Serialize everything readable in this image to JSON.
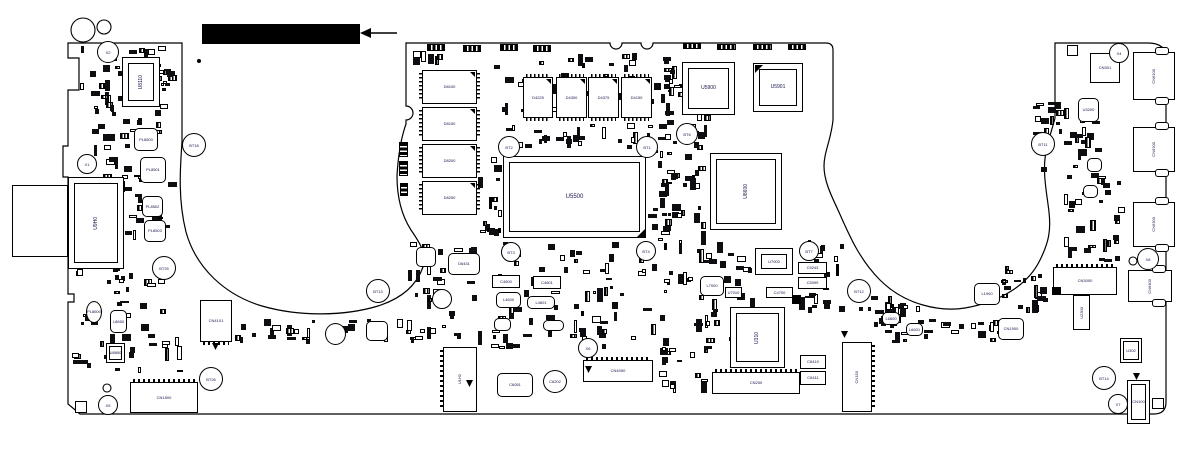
{
  "annotation": {
    "redacted_label": {
      "x": 202,
      "y": 24,
      "w": 158,
      "h": 20,
      "color": "#000000"
    },
    "arrow": {
      "x1": 397,
      "y1": 33,
      "x2": 368,
      "y2": 33,
      "head": [
        [
          360,
          33
        ],
        [
          371,
          28
        ],
        [
          371,
          38
        ]
      ]
    }
  },
  "board": {
    "colors": {
      "outline": "#000000",
      "fill": "#ffffff",
      "label": "#14144a",
      "part_dark": "#0d0d12"
    },
    "outline_paths": [
      "M68 43 L182 43 L182 142 C180 170 178 200 186 232 C196 268 225 295 262 306 C300 317 345 316 378 306 C400 299 416 287 423 267 C427 254 420 243 411 230 C402 216 397 198 397 176 C398 158 401 138 406 124 L406 120 A7 7 0 0 0 406 106 L406 43 L610 43 A6 6 0 0 0 622 43 L641 43 A6 6 0 0 0 653 43 L826 43 Q833 43 833 50 L833 120 C831 140 824 152 824 166 C824 180 830 193 838 210 C848 232 858 258 880 280 C905 305 940 312 965 308 C1000 302 1028 285 1040 260 C1049 242 1051 230 1049 212 C1047 194 1042 172 1046 152 C1048 140 1052 130 1055 118 L1055 43 L1148 43 Q1166 43 1166 58 L1166 402 Q1166 414 1154 414 L80 414 L68 404 L68 302 L74 302 L74 294 L68 294 L68 177 L63 177 L63 146 L68 146 L68 90 L79 90 L79 58 L68 58 Z"
    ],
    "holes": [
      {
        "x": 83,
        "y": 30,
        "r": 12
      },
      {
        "x": 104,
        "y": 27,
        "r": 7
      },
      {
        "x": 107,
        "y": 388,
        "r": 4
      },
      {
        "x": 1133,
        "y": 261,
        "r": 4
      }
    ],
    "dots": [
      {
        "x": 199,
        "y": 61,
        "r": 2
      }
    ],
    "ref_circles": [
      {
        "label": "X2",
        "x": 107,
        "y": 51,
        "r": 10
      },
      {
        "label": "X1",
        "x": 86,
        "y": 163,
        "r": 9
      },
      {
        "label": "BT18",
        "x": 193,
        "y": 144,
        "r": 11
      },
      {
        "label": "BT25",
        "x": 163,
        "y": 267,
        "r": 11
      },
      {
        "label": "BT26",
        "x": 210,
        "y": 378,
        "r": 11
      },
      {
        "label": "X5",
        "x": 107,
        "y": 404,
        "r": 9
      },
      {
        "label": "BT13",
        "x": 377,
        "y": 290,
        "r": 11
      },
      {
        "label": "BT2",
        "x": 508,
        "y": 146,
        "r": 10
      },
      {
        "label": "BT1",
        "x": 646,
        "y": 146,
        "r": 10
      },
      {
        "label": "BT6",
        "x": 686,
        "y": 133,
        "r": 10
      },
      {
        "label": "BT3",
        "x": 510,
        "y": 251,
        "r": 9
      },
      {
        "label": "BT4",
        "x": 645,
        "y": 250,
        "r": 9
      },
      {
        "label": "X6",
        "x": 587,
        "y": 347,
        "r": 9
      },
      {
        "label": "BT7",
        "x": 808,
        "y": 250,
        "r": 9
      },
      {
        "label": "BT12",
        "x": 858,
        "y": 290,
        "r": 11
      },
      {
        "label": "BT11",
        "x": 1042,
        "y": 143,
        "r": 11
      },
      {
        "label": "X4",
        "x": 1118,
        "y": 52,
        "r": 9
      },
      {
        "label": "X8",
        "x": 1147,
        "y": 258,
        "r": 10
      },
      {
        "label": "BT14",
        "x": 1103,
        "y": 377,
        "r": 11
      },
      {
        "label": "X7",
        "x": 1117,
        "y": 403,
        "r": 9
      }
    ],
    "components": [
      {
        "id": "U8110",
        "t": "bga",
        "x": 122,
        "y": 57,
        "w": 38,
        "h": 50,
        "o": "v",
        "sz": "med"
      },
      {
        "id": "U9H0",
        "t": "bga",
        "x": 68,
        "y": 177,
        "w": 56,
        "h": 92,
        "o": "v",
        "sz": "med"
      },
      {
        "id": "",
        "t": "rect-plain",
        "x": 12,
        "y": 185,
        "w": 56,
        "h": 72
      },
      {
        "id": "U5500",
        "t": "bga",
        "x": 503,
        "y": 156,
        "w": 143,
        "h": 82,
        "sz": "big"
      },
      {
        "id": "U5900",
        "t": "bga",
        "x": 682,
        "y": 62,
        "w": 53,
        "h": 53,
        "sz": "med"
      },
      {
        "id": "U5901",
        "t": "bga",
        "x": 753,
        "y": 63,
        "w": 50,
        "h": 49,
        "sz": "med"
      },
      {
        "id": "U8600",
        "t": "bga",
        "x": 710,
        "y": 153,
        "w": 72,
        "h": 77,
        "o": "v",
        "sz": "med"
      },
      {
        "id": "U310",
        "t": "bga",
        "x": 730,
        "y": 307,
        "w": 55,
        "h": 61,
        "o": "v",
        "sz": "med"
      },
      {
        "id": "U7000",
        "t": "bga",
        "x": 755,
        "y": 248,
        "w": 38,
        "h": 27
      },
      {
        "id": "U8650",
        "t": "bga-sm",
        "x": 106,
        "y": 343,
        "w": 19,
        "h": 20
      },
      {
        "id": "U302",
        "t": "bga-sm",
        "x": 1120,
        "y": 338,
        "w": 22,
        "h": 25
      },
      {
        "id": "U2300",
        "t": "rect",
        "x": 1073,
        "y": 295,
        "w": 17,
        "h": 35,
        "o": "v"
      },
      {
        "id": "D8100",
        "t": "mem-v",
        "x": 422,
        "y": 70,
        "w": 55,
        "h": 34,
        "tri": true
      },
      {
        "id": "D8150",
        "t": "mem-v",
        "x": 422,
        "y": 107,
        "w": 55,
        "h": 34,
        "tri": true
      },
      {
        "id": "D8200",
        "t": "mem-v",
        "x": 422,
        "y": 144,
        "w": 55,
        "h": 34,
        "tri": true
      },
      {
        "id": "D8250",
        "t": "mem-v",
        "x": 422,
        "y": 181,
        "w": 55,
        "h": 34,
        "tri": true
      },
      {
        "id": "D4225",
        "t": "mem-h",
        "x": 523,
        "y": 77,
        "w": 30,
        "h": 41,
        "tri": true
      },
      {
        "id": "D4300",
        "t": "mem-h",
        "x": 556,
        "y": 77,
        "w": 31,
        "h": 41,
        "tri": true
      },
      {
        "id": "D4375",
        "t": "mem-h",
        "x": 588,
        "y": 77,
        "w": 31,
        "h": 41,
        "tri": true
      },
      {
        "id": "D4150",
        "t": "mem-h",
        "x": 621,
        "y": 77,
        "w": 31,
        "h": 41,
        "tri": true
      },
      {
        "id": "CN1800",
        "t": "conn-top",
        "x": 130,
        "y": 382,
        "w": 68,
        "h": 31
      },
      {
        "id": "CN4101",
        "t": "conn-bottom",
        "x": 200,
        "y": 300,
        "w": 32,
        "h": 42
      },
      {
        "id": "U1H2",
        "t": "conn-left",
        "x": 443,
        "y": 347,
        "w": 34,
        "h": 65,
        "o": "v"
      },
      {
        "id": "C6051",
        "t": "ind",
        "x": 497,
        "y": 373,
        "w": 36,
        "h": 24
      },
      {
        "id": "C6202",
        "t": "circ",
        "x": 543,
        "y": 370,
        "w": 24,
        "h": 23
      },
      {
        "id": "CN4050",
        "t": "conn-top",
        "x": 583,
        "y": 360,
        "w": 70,
        "h": 22
      },
      {
        "id": "CN250",
        "t": "conn-top",
        "x": 712,
        "y": 372,
        "w": 88,
        "h": 22
      },
      {
        "id": "CN150",
        "t": "conn-right",
        "x": 842,
        "y": 342,
        "w": 30,
        "h": 70,
        "o": "v"
      },
      {
        "id": "CN3000",
        "t": "conn-top",
        "x": 1053,
        "y": 267,
        "w": 64,
        "h": 28
      },
      {
        "id": "CN6400",
        "t": "port",
        "x": 1128,
        "y": 270,
        "w": 44,
        "h": 32,
        "o": "v"
      },
      {
        "id": "CN6100",
        "t": "port",
        "x": 1133,
        "y": 52,
        "w": 42,
        "h": 48,
        "o": "v"
      },
      {
        "id": "CN6200",
        "t": "port",
        "x": 1133,
        "y": 127,
        "w": 42,
        "h": 45,
        "o": "v"
      },
      {
        "id": "CN6300",
        "t": "port",
        "x": 1133,
        "y": 202,
        "w": 42,
        "h": 45,
        "o": "v"
      },
      {
        "id": "CN100",
        "t": "jack",
        "x": 1127,
        "y": 380,
        "w": 23,
        "h": 44
      },
      {
        "id": "CN301",
        "t": "rect",
        "x": 1090,
        "y": 53,
        "w": 30,
        "h": 30
      },
      {
        "id": "CN1900",
        "t": "ind",
        "x": 998,
        "y": 318,
        "w": 26,
        "h": 22
      },
      {
        "id": "C5243",
        "t": "rect",
        "x": 798,
        "y": 262,
        "w": 29,
        "h": 12
      },
      {
        "id": "C5099",
        "t": "rect",
        "x": 798,
        "y": 277,
        "w": 29,
        "h": 12
      },
      {
        "id": "C4600",
        "t": "rect",
        "x": 492,
        "y": 275,
        "w": 28,
        "h": 13
      },
      {
        "id": "C4601",
        "t": "rect",
        "x": 533,
        "y": 276,
        "w": 28,
        "h": 13
      },
      {
        "id": "U7010",
        "t": "rect",
        "x": 725,
        "y": 287,
        "w": 17,
        "h": 11
      },
      {
        "id": "C4700",
        "t": "rect",
        "x": 766,
        "y": 287,
        "w": 27,
        "h": 11
      },
      {
        "id": "C6410",
        "t": "rect",
        "x": 800,
        "y": 355,
        "w": 26,
        "h": 14
      },
      {
        "id": "C6411",
        "t": "rect",
        "x": 800,
        "y": 371,
        "w": 26,
        "h": 14
      },
      {
        "id": "",
        "t": "rect",
        "x": 1067,
        "y": 45,
        "w": 11,
        "h": 11
      },
      {
        "id": "",
        "t": "rect",
        "x": 1152,
        "y": 398,
        "w": 12,
        "h": 11
      },
      {
        "id": "",
        "t": "rect",
        "x": 75,
        "y": 401,
        "w": 12,
        "h": 12
      },
      {
        "id": "PL8500",
        "t": "ind",
        "x": 134,
        "y": 128,
        "w": 24,
        "h": 23
      },
      {
        "id": "PL8501",
        "t": "ind",
        "x": 140,
        "y": 157,
        "w": 26,
        "h": 26
      },
      {
        "id": "PL8502",
        "t": "ind",
        "x": 142,
        "y": 196,
        "w": 21,
        "h": 21
      },
      {
        "id": "PL8503",
        "t": "ind",
        "x": 144,
        "y": 220,
        "w": 22,
        "h": 22
      },
      {
        "id": "PL8600",
        "t": "circ",
        "x": 86,
        "y": 301,
        "w": 16,
        "h": 22
      },
      {
        "id": "L8650",
        "t": "ind",
        "x": 110,
        "y": 310,
        "w": 17,
        "h": 23
      },
      {
        "id": "L4600",
        "t": "ind",
        "x": 496,
        "y": 292,
        "w": 25,
        "h": 16
      },
      {
        "id": "L4601",
        "t": "ind",
        "x": 527,
        "y": 296,
        "w": 28,
        "h": 13
      },
      {
        "id": "",
        "t": "ind",
        "x": 494,
        "y": 318,
        "w": 17,
        "h": 13
      },
      {
        "id": "",
        "t": "ind",
        "x": 543,
        "y": 320,
        "w": 21,
        "h": 11
      },
      {
        "id": "D6431",
        "t": "ind",
        "x": 448,
        "y": 253,
        "w": 32,
        "h": 22
      },
      {
        "id": "",
        "t": "circ",
        "x": 432,
        "y": 289,
        "w": 20,
        "h": 20
      },
      {
        "id": "",
        "t": "ind",
        "x": 416,
        "y": 247,
        "w": 20,
        "h": 20
      },
      {
        "id": "L7000",
        "t": "ind",
        "x": 700,
        "y": 276,
        "w": 24,
        "h": 20
      },
      {
        "id": "L6600",
        "t": "ind",
        "x": 882,
        "y": 312,
        "w": 18,
        "h": 13
      },
      {
        "id": "L6601",
        "t": "ind",
        "x": 906,
        "y": 323,
        "w": 17,
        "h": 13
      },
      {
        "id": "L1900",
        "t": "ind",
        "x": 974,
        "y": 283,
        "w": 26,
        "h": 22
      },
      {
        "id": "U3200",
        "t": "ind",
        "x": 1078,
        "y": 98,
        "w": 21,
        "h": 24
      },
      {
        "id": "",
        "t": "ind",
        "x": 1087,
        "y": 158,
        "w": 15,
        "h": 14
      },
      {
        "id": "",
        "t": "ind",
        "x": 1083,
        "y": 185,
        "w": 15,
        "h": 13
      },
      {
        "id": "",
        "t": "circ",
        "x": 325,
        "y": 323,
        "w": 21,
        "h": 22
      },
      {
        "id": "",
        "t": "ind",
        "x": 366,
        "y": 321,
        "w": 22,
        "h": 20
      },
      {
        "id": "",
        "t": "bar-h",
        "x": 427,
        "y": 44,
        "w": 18,
        "h": 7
      },
      {
        "id": "",
        "t": "bar-h",
        "x": 463,
        "y": 45,
        "w": 18,
        "h": 7
      },
      {
        "id": "",
        "t": "bar-h",
        "x": 500,
        "y": 44,
        "w": 18,
        "h": 7
      },
      {
        "id": "",
        "t": "bar-h",
        "x": 533,
        "y": 45,
        "w": 18,
        "h": 7
      },
      {
        "id": "",
        "t": "bar-h",
        "x": 683,
        "y": 43,
        "w": 18,
        "h": 6
      },
      {
        "id": "",
        "t": "bar-h",
        "x": 717,
        "y": 44,
        "w": 19,
        "h": 6
      },
      {
        "id": "",
        "t": "bar-h",
        "x": 753,
        "y": 44,
        "w": 19,
        "h": 6
      },
      {
        "id": "",
        "t": "bar-h",
        "x": 788,
        "y": 44,
        "w": 18,
        "h": 6
      },
      {
        "id": "",
        "t": "bar-v",
        "x": 399,
        "y": 142,
        "w": 9,
        "h": 15
      },
      {
        "id": "",
        "t": "bar-v",
        "x": 399,
        "y": 161,
        "w": 9,
        "h": 15
      },
      {
        "id": "",
        "t": "bar-v",
        "x": 400,
        "y": 183,
        "w": 8,
        "h": 13
      },
      {
        "id": "",
        "t": "solid",
        "x": 792,
        "y": 295,
        "w": 9,
        "h": 9
      },
      {
        "id": "",
        "t": "solid",
        "x": 1052,
        "y": 287,
        "w": 9,
        "h": 8
      },
      {
        "id": "",
        "t": "tri-br",
        "x": 637,
        "y": 229,
        "w": 8,
        "h": 8
      },
      {
        "id": "",
        "t": "tri-tl",
        "x": 755,
        "y": 65,
        "w": 8,
        "h": 8
      },
      {
        "id": "",
        "t": "tri-down",
        "x": 212,
        "y": 343,
        "w": 7,
        "h": 7
      },
      {
        "id": "",
        "t": "tri-down",
        "x": 585,
        "y": 366,
        "w": 7,
        "h": 7
      },
      {
        "id": "",
        "t": "tri-down",
        "x": 466,
        "y": 380,
        "w": 7,
        "h": 7
      },
      {
        "id": "",
        "t": "tri-down",
        "x": 841,
        "y": 331,
        "w": 7,
        "h": 7
      },
      {
        "id": "",
        "t": "tri-down",
        "x": 1133,
        "y": 373,
        "w": 7,
        "h": 7
      }
    ],
    "noise_clusters": [
      {
        "x": 76,
        "y": 45,
        "w": 100,
        "h": 68,
        "n": 42,
        "seed": 1
      },
      {
        "x": 90,
        "y": 96,
        "w": 88,
        "h": 148,
        "n": 58,
        "seed": 2
      },
      {
        "x": 72,
        "y": 262,
        "w": 112,
        "h": 112,
        "n": 48,
        "seed": 3
      },
      {
        "x": 235,
        "y": 318,
        "w": 178,
        "h": 26,
        "n": 26,
        "seed": 4
      },
      {
        "x": 408,
        "y": 50,
        "w": 42,
        "h": 16,
        "n": 6,
        "seed": 5
      },
      {
        "x": 482,
        "y": 52,
        "w": 195,
        "h": 64,
        "n": 40,
        "seed": 6
      },
      {
        "x": 655,
        "y": 58,
        "w": 58,
        "h": 92,
        "n": 32,
        "seed": 7
      },
      {
        "x": 505,
        "y": 122,
        "w": 148,
        "h": 28,
        "n": 26,
        "seed": 8
      },
      {
        "x": 478,
        "y": 152,
        "w": 26,
        "h": 90,
        "n": 16,
        "seed": 9
      },
      {
        "x": 648,
        "y": 150,
        "w": 60,
        "h": 96,
        "n": 42,
        "seed": 10
      },
      {
        "x": 408,
        "y": 238,
        "w": 74,
        "h": 110,
        "n": 34,
        "seed": 11
      },
      {
        "x": 484,
        "y": 240,
        "w": 175,
        "h": 110,
        "n": 70,
        "seed": 12
      },
      {
        "x": 660,
        "y": 240,
        "w": 98,
        "h": 116,
        "n": 52,
        "seed": 13
      },
      {
        "x": 798,
        "y": 240,
        "w": 48,
        "h": 76,
        "n": 22,
        "seed": 14
      },
      {
        "x": 655,
        "y": 345,
        "w": 58,
        "h": 48,
        "n": 16,
        "seed": 15
      },
      {
        "x": 874,
        "y": 300,
        "w": 56,
        "h": 46,
        "n": 18,
        "seed": 16
      },
      {
        "x": 995,
        "y": 262,
        "w": 55,
        "h": 52,
        "n": 20,
        "seed": 17
      },
      {
        "x": 855,
        "y": 290,
        "w": 50,
        "h": 40,
        "n": 14,
        "seed": 18
      },
      {
        "x": 920,
        "y": 316,
        "w": 90,
        "h": 28,
        "n": 16,
        "seed": 19
      },
      {
        "x": 1032,
        "y": 92,
        "w": 76,
        "h": 82,
        "n": 30,
        "seed": 20
      },
      {
        "x": 1056,
        "y": 172,
        "w": 72,
        "h": 92,
        "n": 32,
        "seed": 21
      },
      {
        "x": 158,
        "y": 70,
        "w": 22,
        "h": 26,
        "n": 6,
        "seed": 22
      }
    ]
  }
}
